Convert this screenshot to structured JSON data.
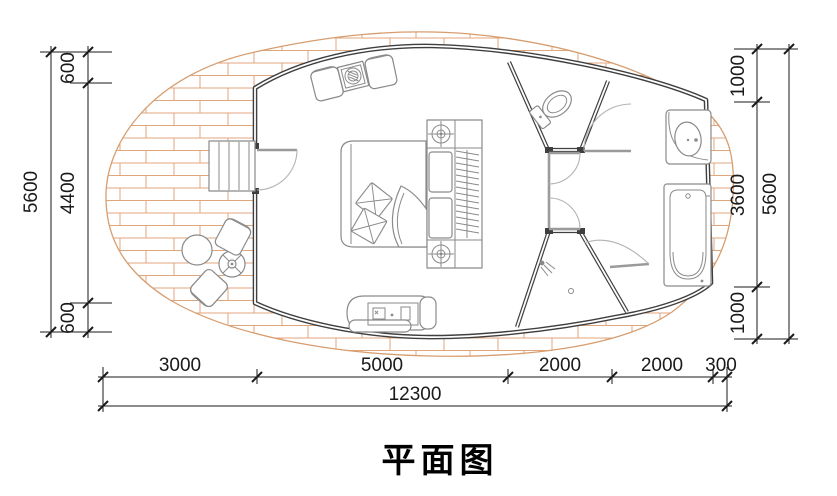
{
  "title": {
    "text": "平面图"
  },
  "dimensions": {
    "left": {
      "segments": [
        "600",
        "4400",
        "600"
      ],
      "total": "5600"
    },
    "right": {
      "segments": [
        "1000",
        "3600",
        "1000"
      ],
      "total": "5600"
    },
    "bottom": {
      "segments": [
        "3000",
        "5000",
        "2000",
        "2000",
        "300"
      ],
      "total": "12300"
    }
  },
  "colors": {
    "brick": "#e0a67c",
    "brick-outline": "#d79d6f",
    "wall": "#3f3f3f",
    "furniture": "#8a8a8a",
    "dim": "#1a1a1a",
    "bg": "#ffffff"
  }
}
